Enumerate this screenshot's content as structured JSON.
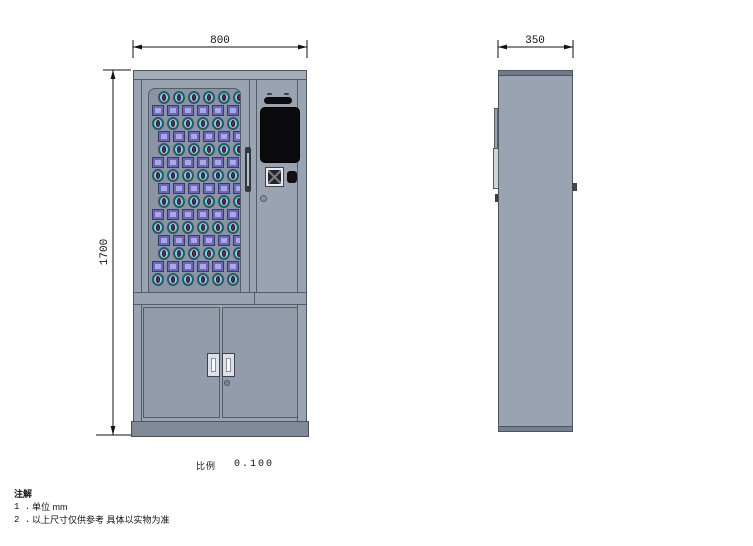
{
  "drawing": {
    "dimensions": {
      "front_width": "800",
      "side_depth": "350",
      "height": "1700"
    },
    "scale": {
      "label": "比例",
      "value": "0.100"
    },
    "notes": {
      "title": "注解",
      "items": [
        {
          "num": "1 .",
          "text": "单位  mm"
        },
        {
          "num": "2 .",
          "text": "以上尺寸仅供参考  具体以实物为准"
        }
      ]
    }
  },
  "front_view": {
    "grid": {
      "rows": 7,
      "cols": 6,
      "leading_oval_row": true
    }
  },
  "colors": {
    "cabinet_body": "#99a3b1",
    "door_panel": "#929cab",
    "window_bg": "#8a94a3",
    "product_box": "#6b68bb",
    "product_box_inner": "#a9a8e2",
    "product_oval": "#7ed2e4",
    "product_oval_core": "#6d2752",
    "screen": "#0b0b0e",
    "base": "#7f8a99"
  }
}
